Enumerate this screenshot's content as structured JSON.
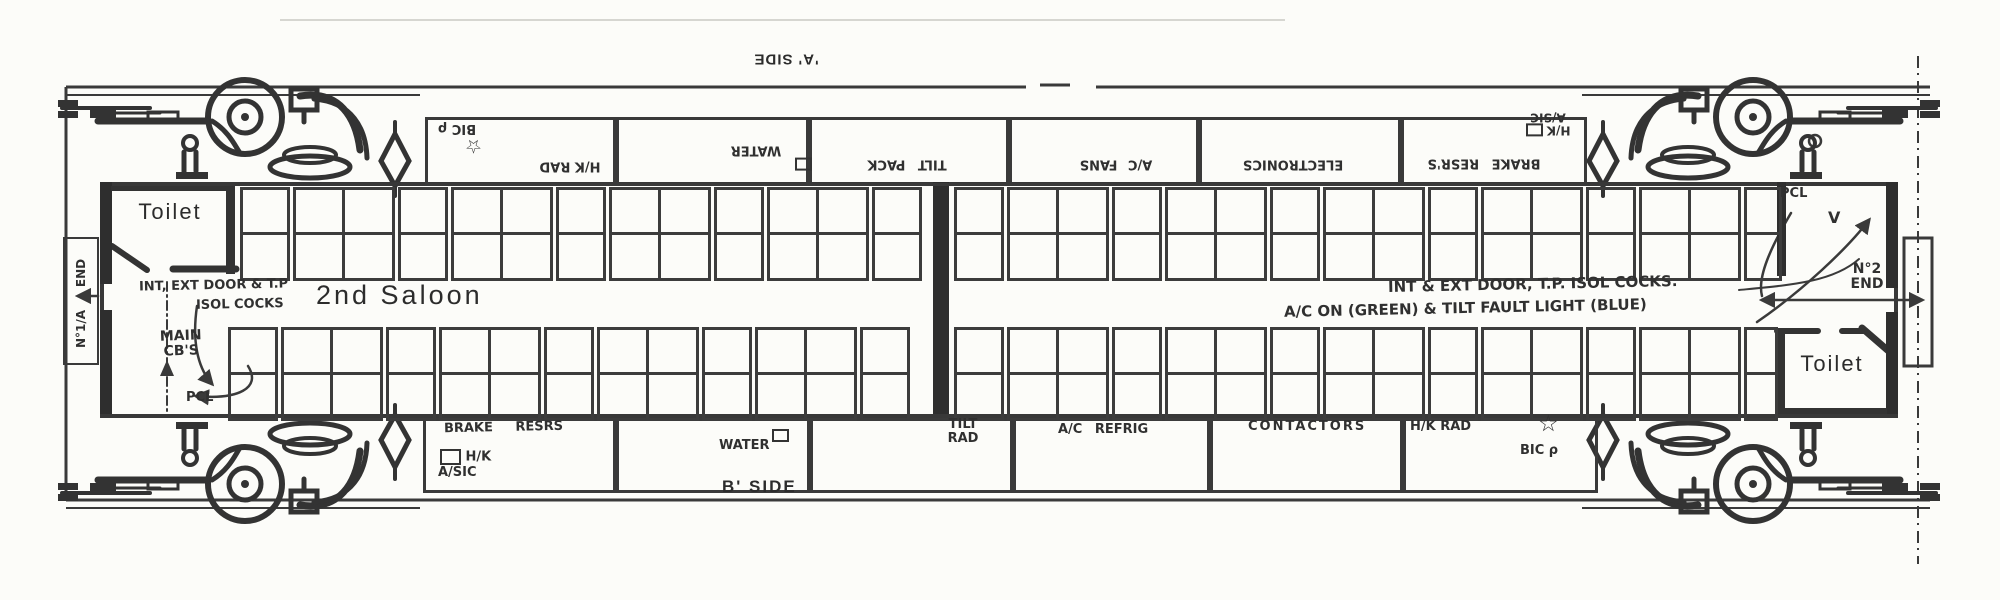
{
  "diagram": {
    "a_side_label": "'A' SIDE",
    "b_side_label": "B' SIDE",
    "saloon_label": "2nd Saloon",
    "toilet_left_label": "Toilet",
    "toilet_right_label": "Toilet",
    "end_1": {
      "word_lower": "N°1/A",
      "word_upper": "END"
    },
    "end_2": {
      "line1": "N°2",
      "line2": "END"
    }
  },
  "annotations": {
    "left_door_line1": "INT, EXT DOOR & T.P",
    "left_door_line2": "ISOL COCKS",
    "main_cbs_line1": "MAIN",
    "main_cbs_line2": "CB'S",
    "pcl_left": "PCL",
    "pcl_right": "PCL",
    "v_mark": "V",
    "right_door": "INT & EXT DOOR, T.P. ISOL COCKS.",
    "right_lights": "A/C ON (GREEN) & TILT FAULT LIGHT (BLUE)"
  },
  "equipment_top": {
    "bic": "BIC ρ",
    "hk_rad": "H/K RAD",
    "water": "WATER",
    "tilt_pack": "TILT PACK",
    "ac_fans": "A/C FANS",
    "electronics": "ELECTRONICS",
    "brake_resrs": "BRAKE RESR'S",
    "hk": "H/K",
    "asic": "A/SIC"
  },
  "equipment_bottom": {
    "brake_resrs": "BRAKE RESRS",
    "hk": "H/K",
    "asic": "A/SIC",
    "water": "WATER",
    "tilt": "TILT",
    "rad": "RAD",
    "ac_refrig": "A/C REFRIG",
    "contactors": "CONTACTORS",
    "hk_rad": "H/K RAD",
    "bic": "BIC ρ"
  },
  "icons": {
    "star": "☆"
  },
  "colors": {
    "ink": "#3a3a3a",
    "paper": "#fcfcf9"
  }
}
